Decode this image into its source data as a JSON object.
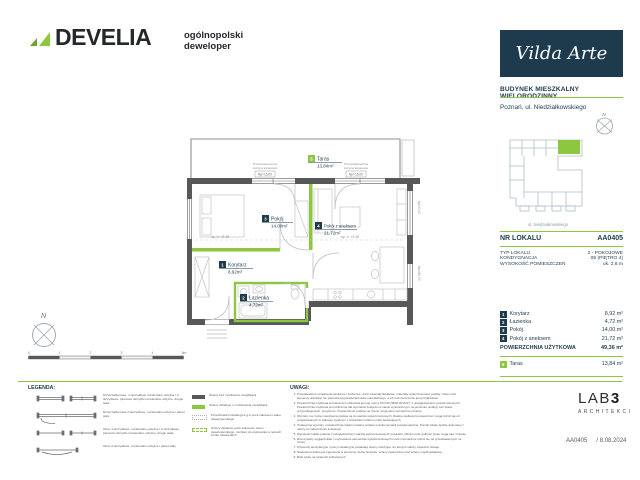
{
  "brand": {
    "name": "DEVELIA",
    "tagline_line1": "ogólnopolski",
    "tagline_line2": "deweloper"
  },
  "project": {
    "logo_text": "Vilda Arte",
    "building_type": "BUDYNEK MIESZKALNY WIELORODZINNY",
    "address": "Poznań, ul. Niedziałkowskiego",
    "compass_n": "N",
    "map_street": "ul. Niedziałkowskiego"
  },
  "unit": {
    "nr_label": "NR LOKALU",
    "nr_value": "AA0405",
    "info": [
      {
        "label": "TYP LOKALU",
        "value": "2 - POKOJOWE"
      },
      {
        "label": "KONDYGNACJA",
        "value": "05 (PIĘTRO 4)"
      },
      {
        "label": "WYSOKOŚĆ POMIESZCZEŃ",
        "value": "ok. 2,6 m"
      }
    ],
    "rooms": [
      {
        "no": "1",
        "name": "Korytarz",
        "area": "8,92 m²"
      },
      {
        "no": "2",
        "name": "Łazienka",
        "area": "4,72 m²"
      },
      {
        "no": "3",
        "name": "Pokój",
        "area": "14,00 m²"
      },
      {
        "no": "4",
        "name": "Pokój z aneksem",
        "area": "21,72 m²"
      }
    ],
    "total_label": "POWIERZCHNIA UŻYTKOWA",
    "total_value": "49,36 m²",
    "terrace": {
      "no": "5",
      "name": "Taras",
      "area": "13,84 m²"
    }
  },
  "plan": {
    "labels": {
      "taras": {
        "no": "5",
        "name": "Taras",
        "area": "13,84m²"
      },
      "pokoj": {
        "no": "3",
        "name": "Pokój",
        "area": "14,00m²"
      },
      "aneks": {
        "no": "4",
        "name": "Pokój z aneksem",
        "area": "21,72m²"
      },
      "korytarz": {
        "no": "1",
        "name": "Korytarz",
        "area": "8,92m²"
      },
      "lazienka": {
        "no": "2",
        "name": "Łazienka",
        "area": "4,72m²"
      }
    },
    "curtain": {
      "line1": "Przeciwsłoneczna",
      "line2": "kurtyna ekranowa",
      "np": "Np=15,00"
    },
    "height_note": "np. h. +2,45",
    "parapet_top": "Np=0,00",
    "parapet_bottom": "Np=90,00",
    "compass_n": "N",
    "scale_ticks": [
      "0",
      "1",
      "2",
      "3",
      "4",
      "5m"
    ]
  },
  "legend": {
    "title": "LEGENDA:",
    "openings": [
      "Drzwi balkonowe, 1-skrzydłowe rozwieralno-uchylne i 2-skrzydłowe, pierwsze skrzydło rozwieralno-uchylne, drugie stałe",
      "Drzwi balkonowe 2-skrzydłowe, rozwieralno-uchylne i panel stały",
      "Okno 1-skrzydłowe, rozwieralno-uchylne i 2-skrzydłowe, pierwsze skrzydło rozwieralno-uchylne, drugie stałe",
      "Okno 2-skrzydłowe, rozwieralno-uchylne i panel stały"
    ],
    "walls": [
      "Ściany bez możliwości modyfikacji",
      "Ściany działowe z możliwością modyfikacji",
      "Przedścianki instalacyjne g-k poza zakresem stanu deweloperskiego",
      "Ściany działowe poza zakresem stanu deweloperskiego, możliwe do wykonania w ramach zmian lokatorskich"
    ]
  },
  "uwagi": {
    "title": "UWAGI:",
    "items": [
      "Przedstawione urządzenia sanitarne i kuchenne, drzwi wewnątrzlokalowe, materiały wykończeniowe podłóg i ścian oraz elementy aranżacji nie stanowią wyposażenia lokalu mieszkalnego, a ich rozmieszczenie jest przykładowe.",
      "Powierzchnia użytkowa pomieszczeń obliczana jest wg normy PN-ISO 9836:2015-07, z uwzględnieniem tynków ściennych. Powierzchnia użytkowa jest obliczona dla wymiarów budynku w stanie wykończonym na poziomie podłogi, bez listew przypodłogowych, progów itp. Powierzchnie podane na rzucie mogą ulec nieznacznej zmianie.",
      "Wymiary na rzucie mieszkania podane są do warstw wykończeniowych. Realne wielkości pomieszczeń mogą różnić się od projektowanych w zakresie zgodnym z warunkami odbioru robót budowlanych.",
      "Ostateczne wymiary i powierzchnie lokalu zostaną podane w dokumentacji powykonawczej. Pomiar lokalu będzie dokonany z natury po zakończeniu inwestycji.",
      "Wysokość lokalu podana z uwzględnieniem warstw wykończeniowych posadzki. Odcień oraz grubość tynku mogą ulec zmianie.",
      "Rzeczywisty wygląd lokalu i usytuowanie elementów wykończeniowych może nieznacznie różnić się od przedstawionych na rzucie.",
      "Przewody wentylacyjne i piony instalacyjne posiadają otwory rewizyjne, do których należy zapewnić dostęp.",
      "Niedopuszczalna jest ingerencja w elementy nośne budynku, ściany zewnętrzne oraz ściany międzylokalowe.",
      "Brak tynku na ścianach żelbetowych."
    ]
  },
  "footer": {
    "lab": "LAB",
    "three": "3",
    "architekci": "ARCHITEKCI",
    "code": "AA0405",
    "date": "/ 8.08.2024"
  },
  "colors": {
    "navy": "#1e3b4d",
    "green": "#8dc63f",
    "wall_gray": "#57585a"
  }
}
